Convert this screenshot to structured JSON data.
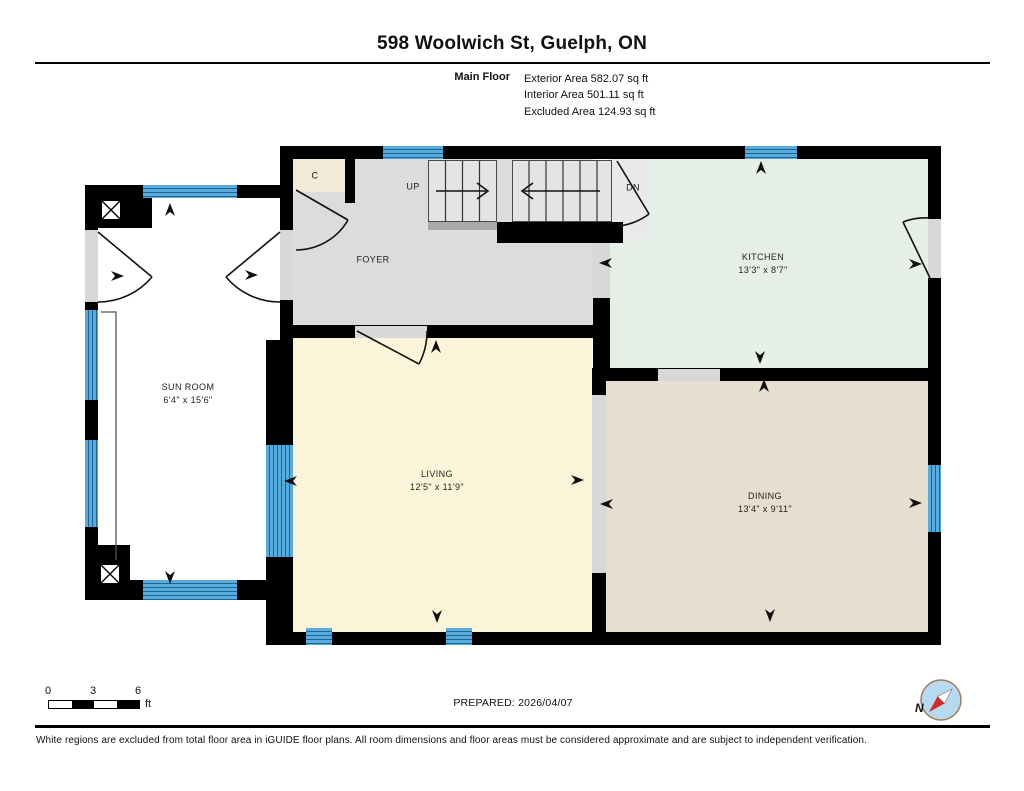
{
  "header": {
    "title": "598 Woolwich St, Guelph, ON",
    "floor_label": "Main Floor",
    "areas": [
      "Exterior Area 582.07 sq ft",
      "Interior Area 501.11 sq ft",
      "Excluded Area 124.93 sq ft"
    ]
  },
  "rooms": {
    "sun_room": {
      "name": "SUN ROOM",
      "dims": "6'4\" x 15'6\""
    },
    "foyer": {
      "name": "FOYER"
    },
    "closet": {
      "name": "C"
    },
    "kitchen": {
      "name": "KITCHEN",
      "dims": "13'3\" x 8'7\""
    },
    "living": {
      "name": "LIVING",
      "dims": "12'5\" x 11'9\""
    },
    "dining": {
      "name": "DINING",
      "dims": "13'4\" x 9'11\""
    }
  },
  "stairs": {
    "up": "UP",
    "dn": "DN"
  },
  "scale_bar": {
    "ticks": [
      "0",
      "3",
      "6"
    ],
    "unit": "ft"
  },
  "compass": {
    "label": "N"
  },
  "footer": {
    "prepared": "PREPARED: 2026/04/07",
    "disclaimer": "White regions are excluded from total floor area in iGUIDE floor plans. All room dimensions and floor areas must be considered approximate and are subject to independent verification."
  },
  "colors": {
    "wall": "#000000",
    "window_blue": "#57abdd",
    "foyer": "#dcdcdc",
    "kitchen": "#e6efe7",
    "living": "#fcf4d9",
    "dining": "#e6decf",
    "closet": "#f3e9d7",
    "sun_room": "#ffffff",
    "opening": "#d8d8d8",
    "compass_ring": "#a87a55",
    "compass_fill": "#b7daf1",
    "needle_red": "#d42a2a"
  }
}
